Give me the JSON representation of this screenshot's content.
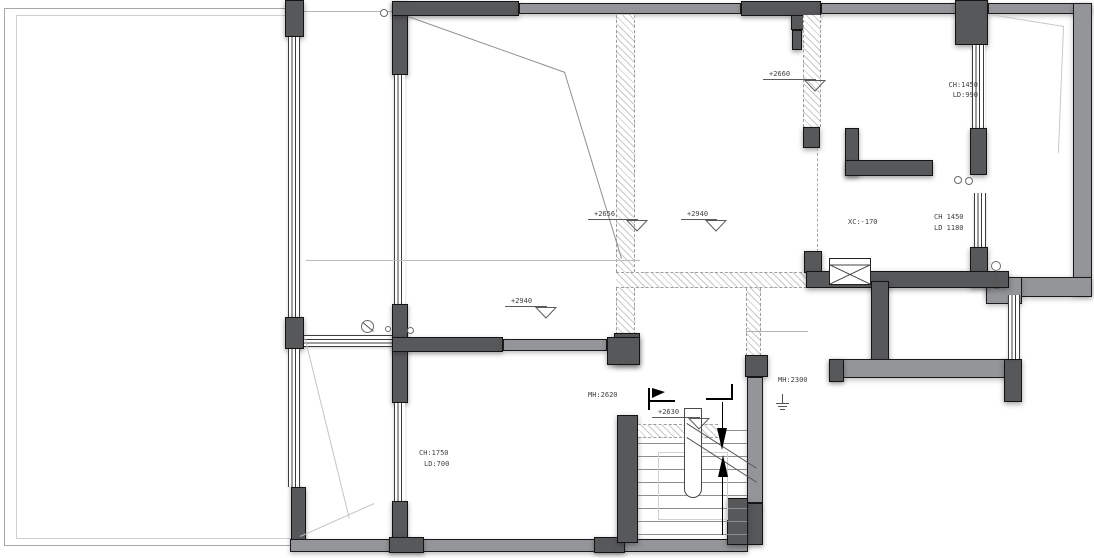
{
  "drawing_type": "residential CAD floor plan with stair and terrace",
  "colors": {
    "wall_dark": "#57585a",
    "wall_light": "#939598",
    "hatch_line": "#c9c9c9",
    "annotation_text": "#3f3f3f"
  },
  "annotations": {
    "win_top_right": {
      "line1": "CH:1450",
      "line2": "LD:990"
    },
    "sunken_floor": "XC:-170",
    "win_mid_right": {
      "line1": "CH 1450",
      "line2": "LD 1180"
    },
    "door_right": "MH:2300",
    "door_stair": "MH:2620",
    "win_bottom_left": {
      "line1": "CH:1750",
      "line2": "LD:700"
    },
    "levels": {
      "top_middle": "+2660",
      "hall_edge": "+2656",
      "mid_room": "+2940",
      "hall": "+2940",
      "stair": "+2630"
    }
  }
}
